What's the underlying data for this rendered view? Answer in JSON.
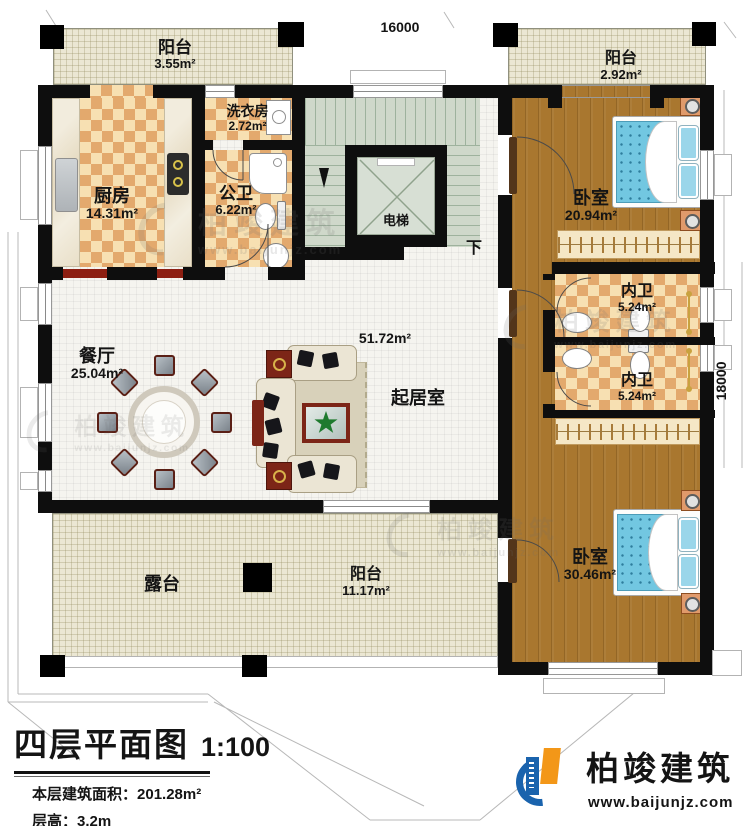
{
  "plan": {
    "dimensions": {
      "width_mm": "16000",
      "height_mm": "18000"
    },
    "rooms": {
      "balcony_tl": {
        "name": "阳台",
        "area": "3.55m²"
      },
      "balcony_tr": {
        "name": "阳台",
        "area": "2.92m²"
      },
      "laundry": {
        "name": "洗衣房",
        "area": "2.72m²"
      },
      "kitchen": {
        "name": "厨房",
        "area": "14.31m²"
      },
      "public_bath": {
        "name": "公卫",
        "area": "6.22m²"
      },
      "elevator": {
        "name": "电梯"
      },
      "bedroom_top": {
        "name": "卧室",
        "area": "20.94m²"
      },
      "ensuite_top": {
        "name": "内卫",
        "area": "5.24m²"
      },
      "ensuite_bottom": {
        "name": "内卫",
        "area": "5.24m²"
      },
      "dining": {
        "name": "餐厅",
        "area": "25.04m²"
      },
      "living": {
        "name": "起居室",
        "area": "51.72m²"
      },
      "bedroom_bottom": {
        "name": "卧室",
        "area": "30.46m²"
      },
      "balcony_bottom": {
        "name": "阳台",
        "area": "11.17m²"
      },
      "terrace": {
        "name": "露台"
      }
    },
    "stairs": {
      "down_label": "下"
    }
  },
  "title_block": {
    "title": "四层平面图",
    "scale": "1:100",
    "area_label": "本层建筑面积：",
    "area_value": "201.28m²",
    "height_label": "层高：",
    "height_value": "3.2m"
  },
  "brand": {
    "name": "柏竣建筑",
    "url": "www.baijunjz.com"
  },
  "watermark": {
    "name": "柏竣建筑",
    "url": "www.baijunjz.com"
  },
  "colors": {
    "wall": "#0e0e0e",
    "wood_floor": "#a9772f",
    "checker_tile": "#e3a96d",
    "balcony_floor": "#ebe7d3",
    "stair_floor": "#cfd8ca",
    "bed_blue": "#72c7e1",
    "accent_red": "#7c2517",
    "brand_blue": "#1a63ad",
    "brand_orange": "#f39718"
  }
}
